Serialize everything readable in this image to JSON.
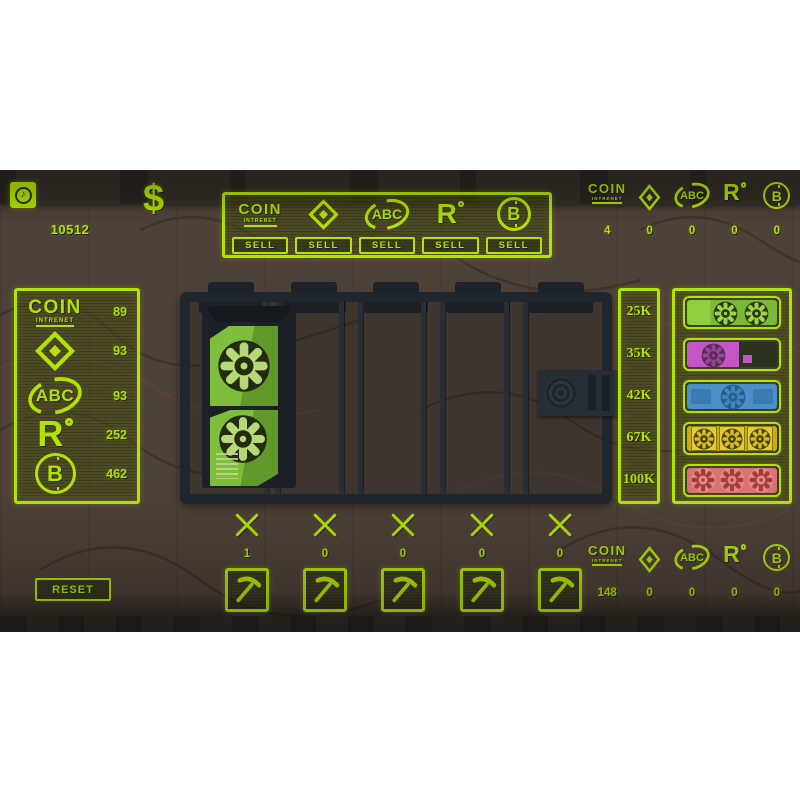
{
  "colors": {
    "neon": "#b3e303",
    "background_wood": "#4e4138",
    "rack_dark": "#20262d",
    "gpu_green": "#79b838",
    "gpu_magenta": "#c455c4",
    "gpu_blue": "#4a8fc7",
    "gpu_yellow": "#d9bb1e",
    "gpu_red": "#db7272"
  },
  "hud": {
    "music_icon": "music-note",
    "currency_symbol": "$",
    "money": "10512",
    "reset_label": "RESET"
  },
  "currencies": [
    {
      "id": "coin-intrenet",
      "label": "COIN",
      "sublabel": "INTRENET"
    },
    {
      "id": "diamond",
      "label": ""
    },
    {
      "id": "abc",
      "label": "ABC"
    },
    {
      "id": "r-degree",
      "label": "R"
    },
    {
      "id": "bitcoin",
      "label": "B"
    }
  ],
  "sell_panel": {
    "sell_label": "SELL"
  },
  "wallet_top": {
    "values": [
      "4",
      "0",
      "0",
      "0",
      "0"
    ]
  },
  "mined_panel": {
    "values": [
      "89",
      "93",
      "93",
      "252",
      "462"
    ]
  },
  "shop": {
    "gpus": [
      {
        "name": "green-dual-fan-gpu",
        "price": "25K",
        "color": "#79b838"
      },
      {
        "name": "magenta-single-fan-gpu",
        "price": "35K",
        "color": "#c455c4"
      },
      {
        "name": "blue-single-fan-gpu",
        "price": "42K",
        "color": "#4a8fc7"
      },
      {
        "name": "yellow-triple-fan-gpu",
        "price": "67K",
        "color": "#d9bb1e"
      },
      {
        "name": "red-triple-fan-gpu",
        "price": "100K",
        "color": "#db7272"
      }
    ]
  },
  "rig": {
    "slot_counts": [
      "1",
      "0",
      "0",
      "0",
      "0"
    ]
  },
  "wallet_bottom": {
    "values": [
      "148",
      "0",
      "0",
      "0",
      "0"
    ]
  }
}
